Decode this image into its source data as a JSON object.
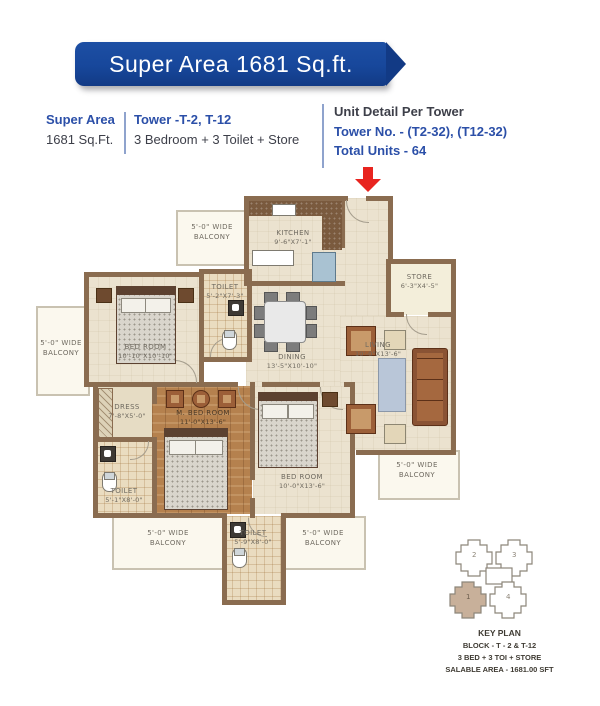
{
  "banner": {
    "title": "Super Area 1681 Sq.ft."
  },
  "info": {
    "super_area_label": "Super Area",
    "super_area_value": "1681 Sq.Ft.",
    "tower_title": "Tower -T-2, T-12",
    "tower_subtitle": "3 Bedroom + 3 Toilet + Store",
    "unit_detail_title": "Unit Detail Per Tower",
    "unit_detail_towers": "Tower No. - (T2-32), (T12-32)",
    "unit_detail_units": "Total Units - 64"
  },
  "plan": {
    "kitchen": {
      "name": "KITCHEN",
      "dim": "9'-6\"X7'-1\""
    },
    "store": {
      "name": "STORE",
      "dim": "6'-3\"X4'-5\""
    },
    "dining": {
      "name": "DINING",
      "dim": "13'-5\"X10'-10\""
    },
    "living": {
      "name": "LIVING",
      "dim": "10'-0\"X13'-6\""
    },
    "bedroom1": {
      "name": "BED ROOM",
      "dim": "10'-10\"X10'-10\""
    },
    "toilet1": {
      "name": "TOILET",
      "dim": "5'-2\"X7'-3\""
    },
    "dress": {
      "name": "DRESS",
      "dim": "7'-8\"X5'-0\""
    },
    "master_bedroom": {
      "name": "M. BED ROOM",
      "dim": "11'-0\"X13'-6\""
    },
    "toilet2": {
      "name": "TOILET",
      "dim": "5'-1\"X8'-0\""
    },
    "bedroom2": {
      "name": "BED ROOM",
      "dim": "10'-0\"X13'-6\""
    },
    "toilet3": {
      "name": "TOILET",
      "dim": "5'-9\"X8'-0\""
    },
    "balcony": {
      "line1": "5'-0\" WIDE",
      "line2": "BALCONY"
    }
  },
  "key_plan": {
    "title": "KEY PLAN",
    "block": "BLOCK - T - 2 & T-12",
    "config": "3 BED + 3 TOI + STORE",
    "salable": "SALABLE AREA - 1681.00 SFT",
    "towers": {
      "t1": "1",
      "t2": "2",
      "t3": "3",
      "t4": "4"
    }
  },
  "colors": {
    "banner_blue": "#17479B",
    "text_blue": "#2B4FA8",
    "arrow_red": "#E8241F",
    "wall_brown": "#8A6C50"
  }
}
